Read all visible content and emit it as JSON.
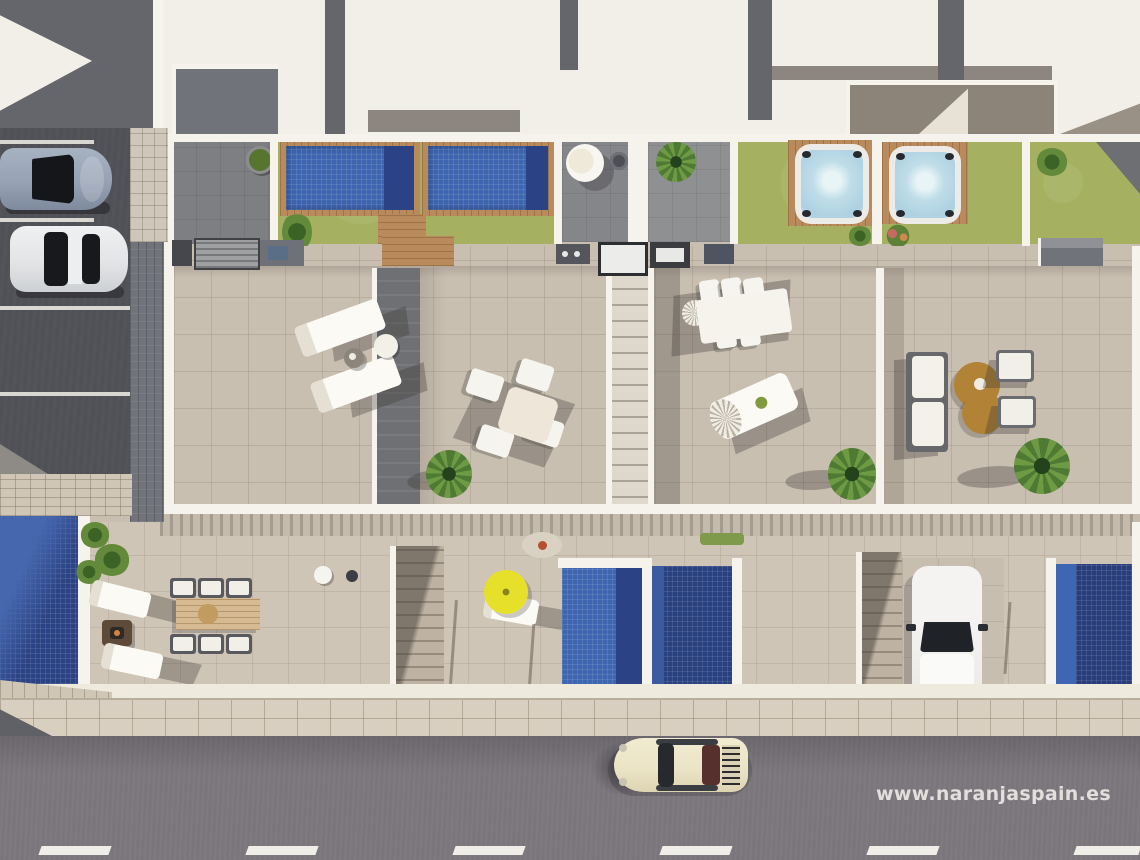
{
  "watermark": {
    "text": "www.naranjaspain.es"
  },
  "palette": {
    "roof_white": "#f2efe8",
    "roof_shadow": "#64666b",
    "roof_brown_shadow": "#8d8680",
    "parapet_white": "#f6f3ec",
    "terrace_beige": "#c9bfb1",
    "terrace_lower_beige": "#cfc5b6",
    "lawn_green": "#a5b160",
    "wood_deck": "#b98a5b",
    "pool_blue": "#3e65b0",
    "pool_navy": "#2b4385",
    "jacuzzi_rim": "#ecebe7",
    "jacuzzi_water": "#aed2e2",
    "patio_gray": "#85868a",
    "asphalt_road": "#7b767c",
    "asphalt_parking": "#505157",
    "sidewalk_tile": "#d9cfc0",
    "paver_gray": "#70737a",
    "brick_light": "#cfc6b6",
    "umbrella_yellow": "#e7e02b",
    "coffee_table_brown": "#b28336",
    "classic_car_cream": "#ebe4c6",
    "sports_car_silver": "#96a2b4",
    "sedan_white": "#e3e4e6",
    "lane_marking": "#f0eee8"
  },
  "scene": {
    "description": "Top-down 3D architectural render of a row of townhouses with rooftop solariums (pools, jacuzzis, lawns), tiled terraces with outdoor furniture, ground-floor patios with pools, a parking strip with two cars, a sidewalk and a street with a classic car.",
    "objects": [
      "rooftop-pool-1",
      "rooftop-pool-2",
      "jacuzzi-1",
      "jacuzzi-2",
      "lawn-areas",
      "sun-loungers",
      "dining-set-4-chairs",
      "dining-table-6-chairs",
      "daybed",
      "lounge-sofa-set",
      "coffee-table",
      "palm-trees",
      "yellow-parasol",
      "ground-pool-left",
      "ground-pool-center-a",
      "ground-pool-center-b",
      "ground-pool-right",
      "outdoor-wood-dining-table",
      "fire-pit-table",
      "staircases",
      "white-suv-in-driveway",
      "sports-car-parked",
      "sedan-parked",
      "classic-car-on-road",
      "sidewalk",
      "road-lane-dashes"
    ]
  }
}
